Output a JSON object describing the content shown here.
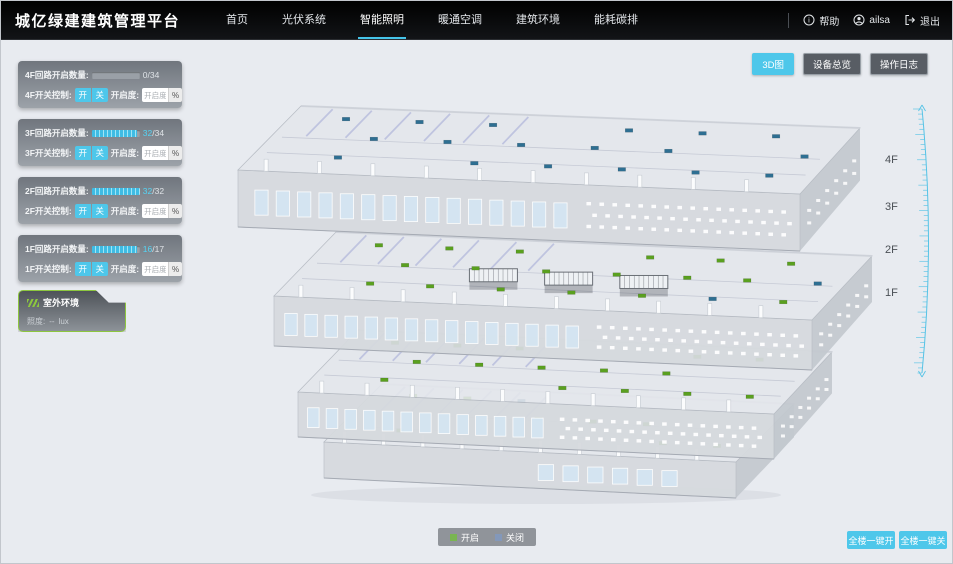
{
  "header": {
    "title": "城亿绿建建筑管理平台",
    "nav": [
      {
        "label": "首页",
        "active": false
      },
      {
        "label": "光伏系统",
        "active": false
      },
      {
        "label": "智能照明",
        "active": true
      },
      {
        "label": "暖通空调",
        "active": false
      },
      {
        "label": "建筑环境",
        "active": false
      },
      {
        "label": "能耗碳排",
        "active": false
      }
    ],
    "help": "帮助",
    "user": "ailsa",
    "logout": "退出"
  },
  "toolbar": {
    "view3d": "3D图",
    "deviceOverview": "设备总览",
    "operationLog": "操作日志"
  },
  "sidebar": {
    "floors": [
      {
        "circuitLabel": "4F回路开启数量:",
        "open": 0,
        "total": 34,
        "switchLabel": "4F开关控制:",
        "onLabel": "开",
        "offLabel": "关",
        "dimLabel": "开启度:",
        "dimPlaceholder": "开启度",
        "percentLabel": "%"
      },
      {
        "circuitLabel": "3F回路开启数量:",
        "open": 32,
        "total": 34,
        "switchLabel": "3F开关控制:",
        "onLabel": "开",
        "offLabel": "关",
        "dimLabel": "开启度:",
        "dimPlaceholder": "开启度",
        "percentLabel": "%"
      },
      {
        "circuitLabel": "2F回路开启数量:",
        "open": 32,
        "total": 32,
        "switchLabel": "2F开关控制:",
        "onLabel": "开",
        "offLabel": "关",
        "dimLabel": "开启度:",
        "dimPlaceholder": "开启度",
        "percentLabel": "%"
      },
      {
        "circuitLabel": "1F回路开启数量:",
        "open": 16,
        "total": 17,
        "switchLabel": "1F开关控制:",
        "onLabel": "开",
        "offLabel": "关",
        "dimLabel": "开启度:",
        "dimPlaceholder": "开启度",
        "percentLabel": "%"
      }
    ],
    "outdoor": {
      "title": "室外环境",
      "illumLabel": "照度:",
      "illumValue": "--",
      "illumUnit": "lux"
    }
  },
  "scene": {
    "floorLabels": [
      "4F",
      "3F",
      "2F",
      "1F"
    ],
    "legend": [
      {
        "label": "开启",
        "color": "#79b551"
      },
      {
        "label": "关闭",
        "color": "#8398ba"
      }
    ],
    "markerColors": {
      "open": "#5aa01f",
      "closed": "#2e6f92"
    }
  },
  "footer": {
    "allOn": "全楼一键开",
    "allOff": "全楼一键关"
  },
  "colors": {
    "accent": "#4ec7ea"
  }
}
